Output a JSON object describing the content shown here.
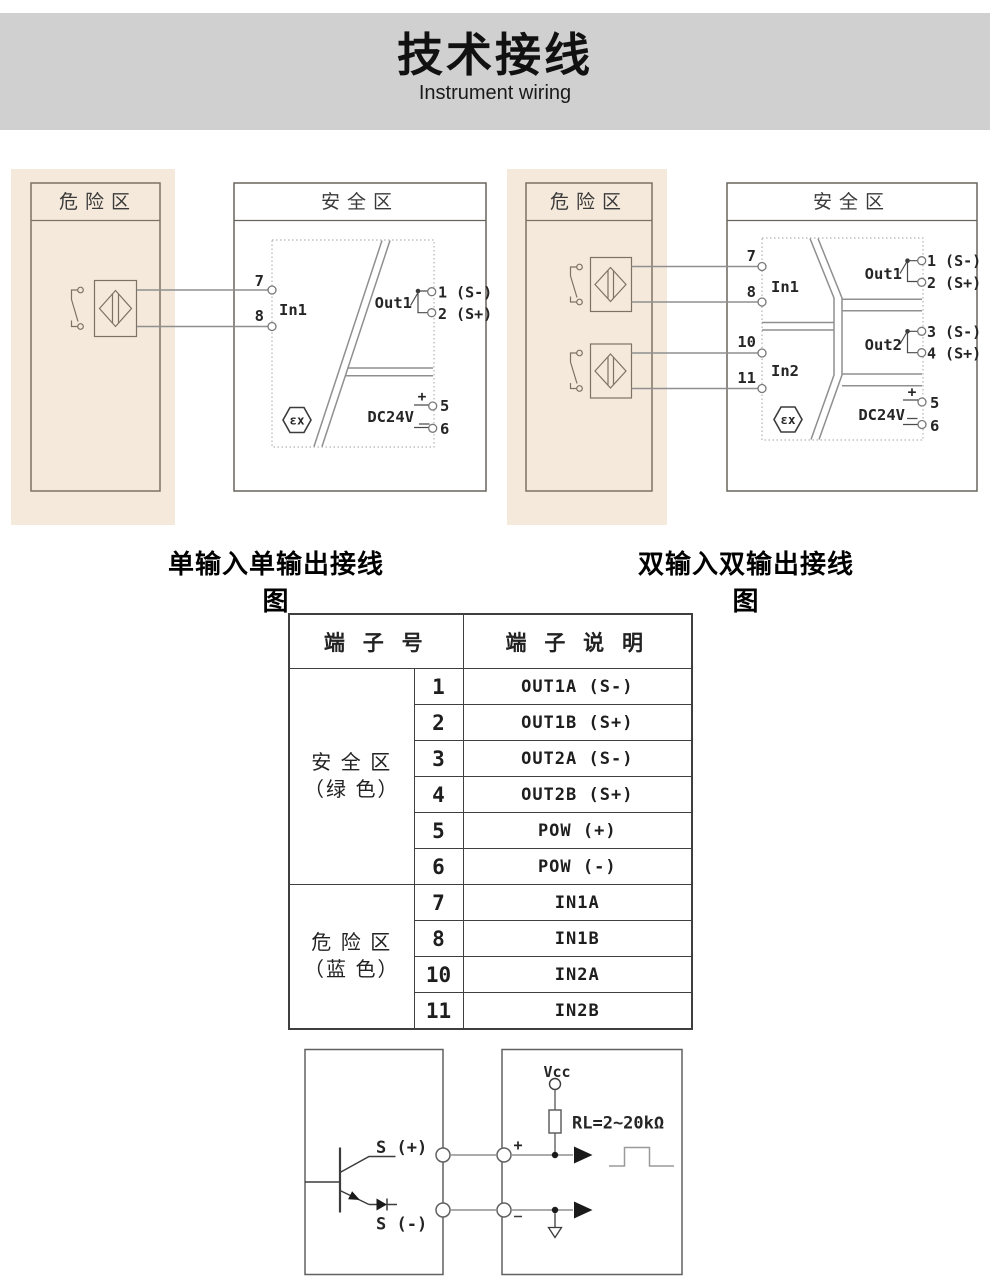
{
  "header": {
    "title": "技术接线",
    "subtitle": "Instrument wiring"
  },
  "colors": {
    "header_band": "#d0d0d0",
    "hazard_zone_bg": "#f5e9db",
    "line_dark": "#3c3c3c",
    "wire_gray": "#8f8f8f"
  },
  "left_diagram": {
    "caption": "单输入单输出接线图",
    "hazard_label": "危险区",
    "safe_label": "安全区",
    "t7": "7",
    "t8": "8",
    "in1": "In1",
    "out1": "Out1",
    "out1_neg": "1 (S-)",
    "out1_pos": "2 (S+)",
    "plus": "+",
    "t5": "5",
    "t6": "6",
    "dc": "DC24V",
    "ex": "εx"
  },
  "right_diagram": {
    "caption": "双输入双输出接线图",
    "hazard_label": "危险区",
    "safe_label": "安全区",
    "t7": "7",
    "t8": "8",
    "t10": "10",
    "t11": "11",
    "in1": "In1",
    "in2": "In2",
    "out1": "Out1",
    "out1_neg": "1 (S-)",
    "out1_pos": "2 (S+)",
    "out2": "Out2",
    "out2_neg": "3 (S-)",
    "out2_pos": "4 (S+)",
    "plus": "+",
    "t5": "5",
    "t6": "6",
    "dc": "DC24V",
    "ex": "εx"
  },
  "table": {
    "header_terminal": "端 子 号",
    "header_desc": "端 子 说 明",
    "group1_line1": "安 全 区",
    "group1_line2": "（绿 色）",
    "group2_line1": "危 险 区",
    "group2_line2": "（蓝 色）",
    "rows": [
      {
        "no": "1",
        "desc": "OUT1A (S-)"
      },
      {
        "no": "2",
        "desc": "OUT1B (S+)"
      },
      {
        "no": "3",
        "desc": "OUT2A (S-)"
      },
      {
        "no": "4",
        "desc": "OUT2B (S+)"
      },
      {
        "no": "5",
        "desc": "POW (+)"
      },
      {
        "no": "6",
        "desc": "POW (-)"
      },
      {
        "no": "7",
        "desc": "IN1A"
      },
      {
        "no": "8",
        "desc": "IN1B"
      },
      {
        "no": "10",
        "desc": "IN2A"
      },
      {
        "no": "11",
        "desc": "IN2B"
      }
    ]
  },
  "circuit": {
    "s_plus": "S (+)",
    "s_minus": "S (-)",
    "vcc": "Vcc",
    "rl": "RL=2~20kΩ",
    "plus": "+",
    "minus": "-"
  }
}
